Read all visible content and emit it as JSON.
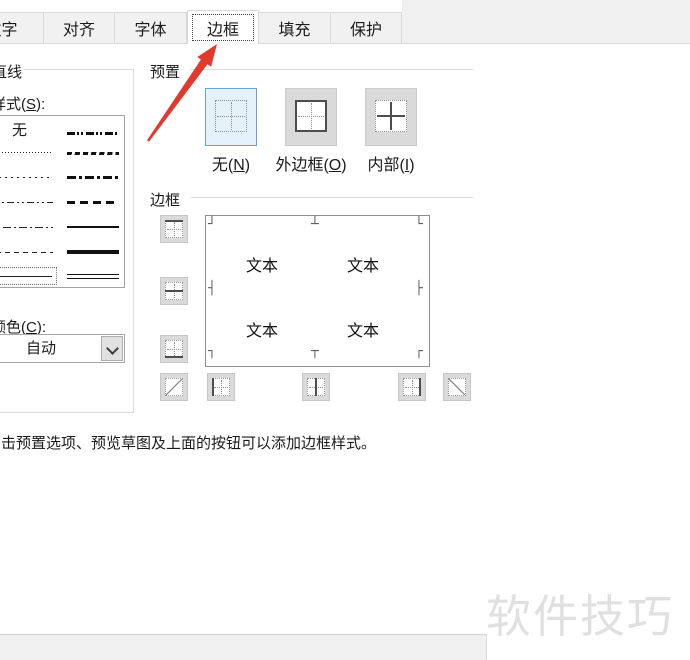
{
  "tabs": [
    {
      "label": "数字",
      "selected": false
    },
    {
      "label": "对齐",
      "selected": false
    },
    {
      "label": "字体",
      "selected": false
    },
    {
      "label": "边框",
      "selected": true
    },
    {
      "label": "填充",
      "selected": false
    },
    {
      "label": "保护",
      "selected": false
    }
  ],
  "line_group": {
    "title": "直线",
    "style_label_pre": "样式(",
    "style_accel": "S",
    "style_label_post": "):",
    "none_item_label": "无",
    "styles_left": [
      "none",
      "dot-fine",
      "dot",
      "dash-dot-dot",
      "dash-dot",
      "dash",
      "thin-solid"
    ],
    "styles_right": [
      "dash-dot-dot-medium",
      "slant-dash-dot",
      "dash-dot-medium",
      "dash-medium",
      "solid-medium",
      "solid-thick",
      "double"
    ],
    "selected_style": "thin-solid",
    "color_label_pre": "颜色(",
    "color_accel": "C",
    "color_label_post": "):",
    "color_value": "自动"
  },
  "presets_group": {
    "title": "预置",
    "buttons": [
      {
        "pre": "无(",
        "accel": "N",
        "post": ")",
        "icon": "border-none-icon",
        "selected": true
      },
      {
        "pre": "外边框(",
        "accel": "O",
        "post": ")",
        "icon": "border-outline-icon",
        "selected": false
      },
      {
        "pre": "内部(",
        "accel": "I",
        "post": ")",
        "icon": "border-inside-icon",
        "selected": false
      }
    ]
  },
  "border_group": {
    "title": "边框",
    "preview_text": "文本",
    "marks": {
      "tl": "┘",
      "tm": "┴",
      "tr": "└",
      "ml": "┤",
      "mr": "├",
      "bl": "┐",
      "bm": "┬",
      "br": "┌"
    },
    "buttons": [
      "top-border",
      "middle-horizontal-border",
      "bottom-border",
      "diagonal-up-border",
      "left-border",
      "middle-vertical-border",
      "right-border",
      "diagonal-down-border"
    ]
  },
  "hint": "击预置选项、预览草图及上面的按钮可以添加边框样式。",
  "watermark": "软件技巧",
  "annotation": {
    "target_tab": "边框"
  },
  "colors": {
    "dialog_bg": "#f0f0f0",
    "selected_preset_bg": "#e5f1fb",
    "selected_preset_border": "#66a1d8",
    "arrow_red": "#e03a2f",
    "watermark_gray": "#e0e0e0"
  }
}
